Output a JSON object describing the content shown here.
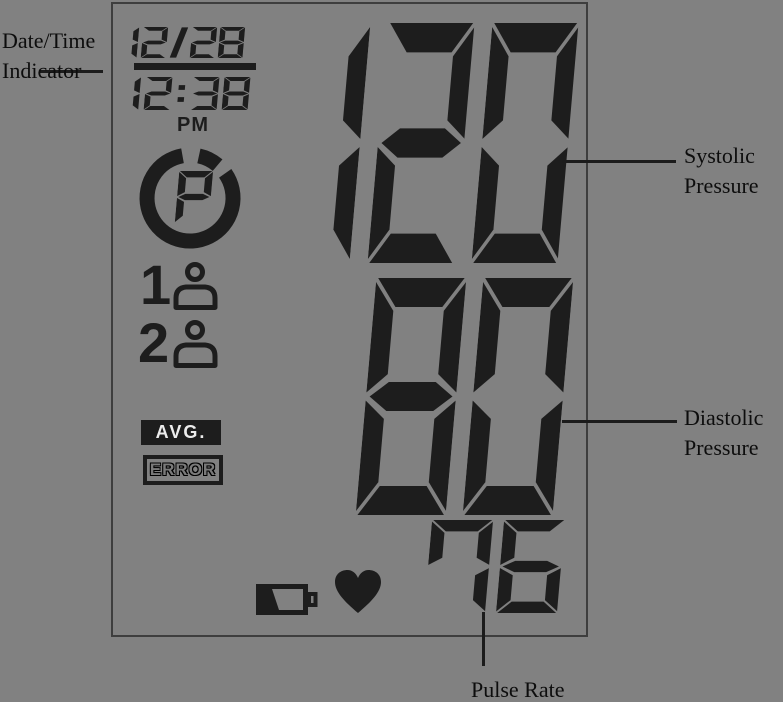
{
  "display": {
    "date": "12/28",
    "time": "12:38",
    "meridiem": "PM",
    "systolic": "120",
    "diastolic": "80",
    "pulse": "76",
    "memory_char": "P",
    "user1_num": "1",
    "user2_num": "2",
    "avg_label": "AVG.",
    "error_label": "ERROR"
  },
  "callouts": {
    "date_time": {
      "line1": "Date/Time",
      "line2": "Indicator"
    },
    "systolic": {
      "line1": "Systolic",
      "line2": "Pressure"
    },
    "diastolic": {
      "line1": "Diastolic",
      "line2": "Pressure"
    },
    "pulse": {
      "line1": "Pulse Rate"
    }
  },
  "icons": {
    "memory": "memory-cycle-icon",
    "user1": "user-icon",
    "user2": "user-icon",
    "battery": "battery-low-icon",
    "heart": "heart-icon"
  },
  "colors": {
    "background": "#818181",
    "segment": "#1d1d1d",
    "label-text": "#0d0d0d",
    "line": "#1c1c1c",
    "panel-border": "#3e3e3e",
    "avg-bg": "#1d1d1d",
    "avg-text": "#ececec",
    "error-text": "#7a7a7a"
  }
}
